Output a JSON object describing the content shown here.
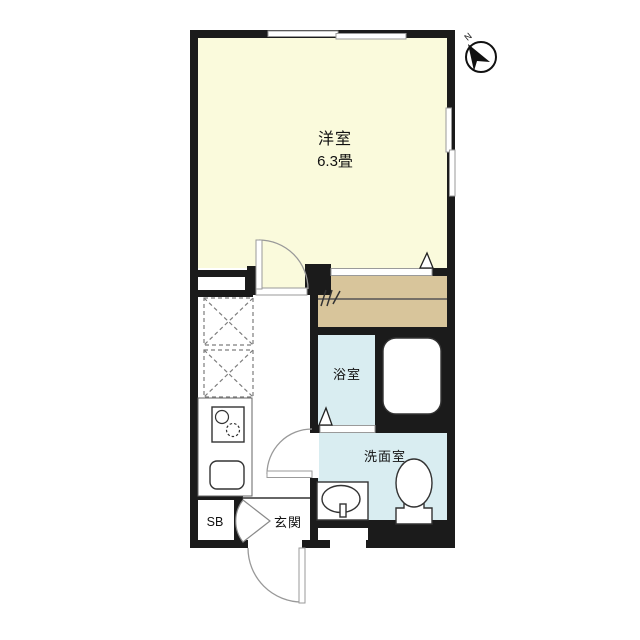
{
  "plan": {
    "type": "apartment-floor-plan",
    "compass": {
      "label": "N"
    },
    "rooms": {
      "western_room": {
        "name": "洋室",
        "size": "6.3畳"
      },
      "bathroom": {
        "name": "浴室"
      },
      "washroom": {
        "name": "洗面室"
      },
      "entrance": {
        "name": "玄関"
      },
      "shoe_box": {
        "name": "SB"
      }
    },
    "palette": {
      "wall": "#1b1b1b",
      "western_room_fill": "#FAFADC",
      "closet_fill": "#D8C59B",
      "wet_area_fill": "#D9EDF1",
      "door_arc": "#999999",
      "fixture_stroke": "#333333",
      "background": "#ffffff"
    }
  }
}
